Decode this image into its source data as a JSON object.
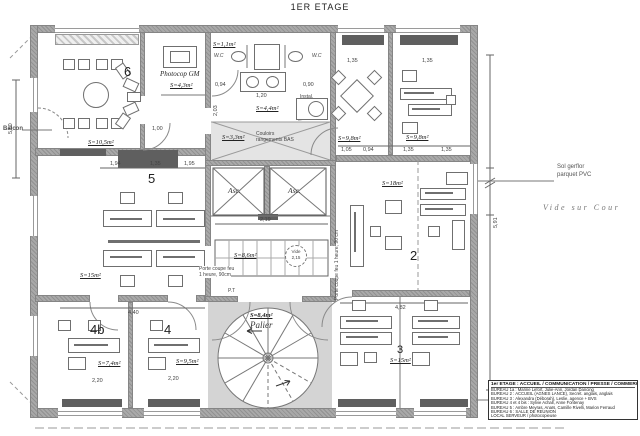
{
  "title": "1ER ETAGE",
  "colors": {
    "wall_gray": "#a2a2a2",
    "dark_gray": "#5f5f5f",
    "line": "#6b6b6b",
    "shade": "#d4d4d4",
    "paper": "#ffffff",
    "text": "#333333"
  },
  "rooms": {
    "r6": {
      "num": "6",
      "area": "S=10,5m²"
    },
    "photocop": {
      "name": "Photocop GM",
      "area": "S=4,3m²"
    },
    "wc": {
      "area": "S=1,1m²",
      "left": "W.C",
      "right": "W.C"
    },
    "instal": {
      "name": "Instal.",
      "area": "S=4,4m²"
    },
    "storage": {
      "area": "S=3,3m²",
      "name1": "Couloirs",
      "name2": "rangements BAS"
    },
    "tr_left": {
      "area": "S=9,8m²"
    },
    "tr_right": {
      "area": "S=9,8m²"
    },
    "r5": {
      "num": "5",
      "area": "S=15m²"
    },
    "r2": {
      "num": "2",
      "area": "S=18m²"
    },
    "corridor": {
      "area": "S=8,6m²",
      "vide1": "Vide",
      "vide2": "2,15"
    },
    "palier": {
      "area": "S=8,4m²",
      "name": "Palier"
    },
    "r4b": {
      "num": "4b",
      "area": "S=7,4m²"
    },
    "r4": {
      "num": "4",
      "area": "S=9,5m²"
    },
    "r3": {
      "num": "3",
      "area": "S=15m²"
    },
    "asc": "Asc."
  },
  "annotations": {
    "balcon": "Balcon",
    "sol1": "Sol gerflor",
    "sol2": "parquet PVC",
    "cour": "Vide sur Cour",
    "fire_l1": "Porte coupe feu",
    "fire_l2": "1 heure, 90cm",
    "fire_r": "Porte coupe feu 1 heure, 90 cm",
    "pt": "P.T"
  },
  "dims": [
    "0,94",
    "0,90",
    "1,20",
    "2,03",
    "1,05",
    "0,94",
    "1,35",
    "1,35",
    "1,94",
    "1,35",
    "1,95",
    "4,40",
    "4,82",
    "2,20",
    "2,20",
    "2,19",
    "5,60",
    "5,91",
    "1,35",
    "1,35",
    "1,00"
  ],
  "legend": {
    "header": "1er ETAGE : ACCUEIL / COMMUNICATION / PRESSE / COMMERCIAL",
    "lines": [
      "BUREAU 1a : Marine Lefort, Julie-Ann, Jordan Dancing",
      "BUREAU 2 : ACCUEIL (AGNES LANCE), Secrét. anglais, anglais",
      "BUREAU 3 : Alexandra (Déborah), Leslie, agence + BVS",
      "BUREAU 4 et 4 bis : Sylvie Achall, Anne Fontenay",
      "BUREAU 5 : Ambre Meyras, Anaïs, Camille Rivelli, Marion Ferraud",
      "BUREAU 6 : SALLE DE REUNION",
      "LOCAL SERVEUR / photocopieuse"
    ]
  }
}
